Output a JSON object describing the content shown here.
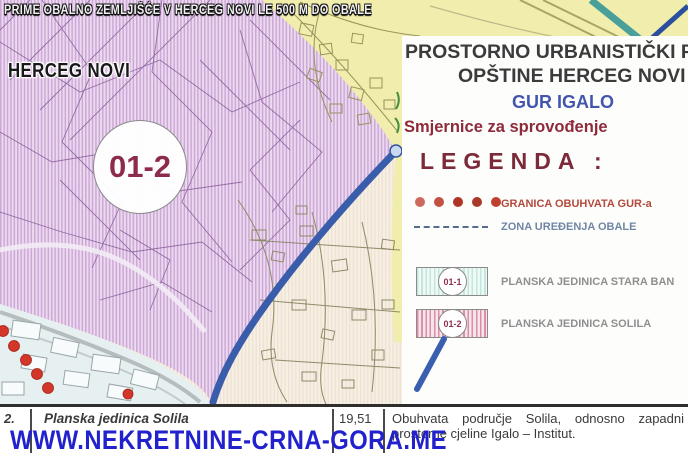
{
  "overlay": {
    "top_caption": "PRIME OBALNO ZEMLJIŠĆE V HERCEG NOVI LE 500 M DO OBALE",
    "city_label": "HERCEG NOVI",
    "watermark": "WWW.NEKRETNINE-CRNA-GORA.ME"
  },
  "map": {
    "zone_circle_label": "01-2"
  },
  "panel": {
    "title_line1": "PROSTORNO URBANISTIČKI P",
    "title_line2": "OPŠTINE HERCEG NOVI",
    "plan_name": "GUR IGALO",
    "subtitle": "Smjernice za sprovođenje",
    "legend_title": "LEGENDA :",
    "legend_items": [
      {
        "symbol": "red-dots",
        "label": "GRANICA OBUHVATA GUR-a"
      },
      {
        "symbol": "dashed-line",
        "label": "ZONA UREĐENJA OBALE"
      },
      {
        "symbol": "hatched-area-cyan",
        "code": "01-1",
        "label": "PLANSKA JEDINICA STARA BAN"
      },
      {
        "symbol": "hatched-area-pink",
        "code": "01-2",
        "label": "PLANSKA JEDINICA SOLILA"
      }
    ]
  },
  "table": {
    "row_number": "2.",
    "unit_name": "Planska jedinica Solila",
    "area_value": "19,51",
    "description_line1": "Obuhvata područje Solila, odnosno zapadni",
    "description_line2": "prostorne cjeline Igalo – Institut."
  },
  "colors": {
    "zone_purple": "#ecdaee",
    "zone_purple_stripe": "#cda7d8",
    "zone_cream": "#f5f0e0",
    "zone_yellow": "#f1edac",
    "zone_lightblue": "#e7f0f1",
    "boundary_blue": "#3a5dab",
    "gur_dot_red": "#d2372a",
    "accent_maroon": "#7c2939",
    "accent_blue": "#4356ae",
    "watermark_blue": "#2121cd"
  }
}
